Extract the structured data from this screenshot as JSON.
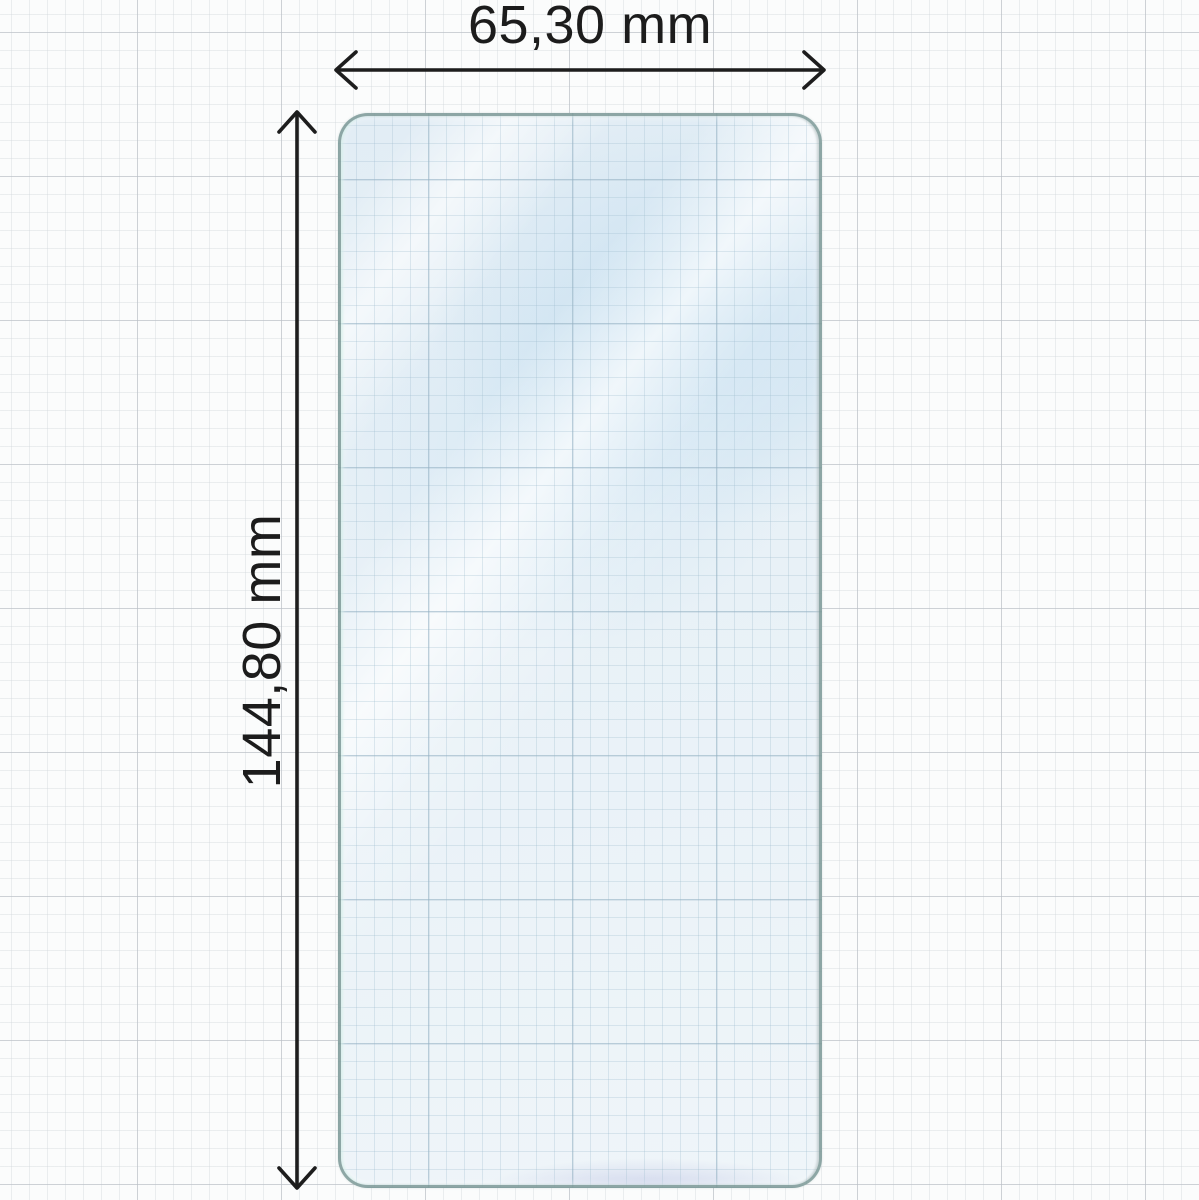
{
  "diagram": {
    "kind": "product-dimension-diagram",
    "subject": "phone screen protector film on graph paper",
    "dimensions": {
      "width": {
        "label": "65,30 mm",
        "value": 65.3,
        "unit": "mm"
      },
      "height": {
        "label": "144,80 mm",
        "value": 144.8,
        "unit": "mm"
      }
    },
    "colors": {
      "arrow_and_text": "#1d1d1d",
      "protector_fill": "#e9f2f7",
      "protector_edge": "#7c9996",
      "paper_minor_grid": "#ebedee",
      "paper_major_grid": "#ccd0d4",
      "inner_grid": "#c5d8e4",
      "background": "#fbfcfc"
    }
  }
}
